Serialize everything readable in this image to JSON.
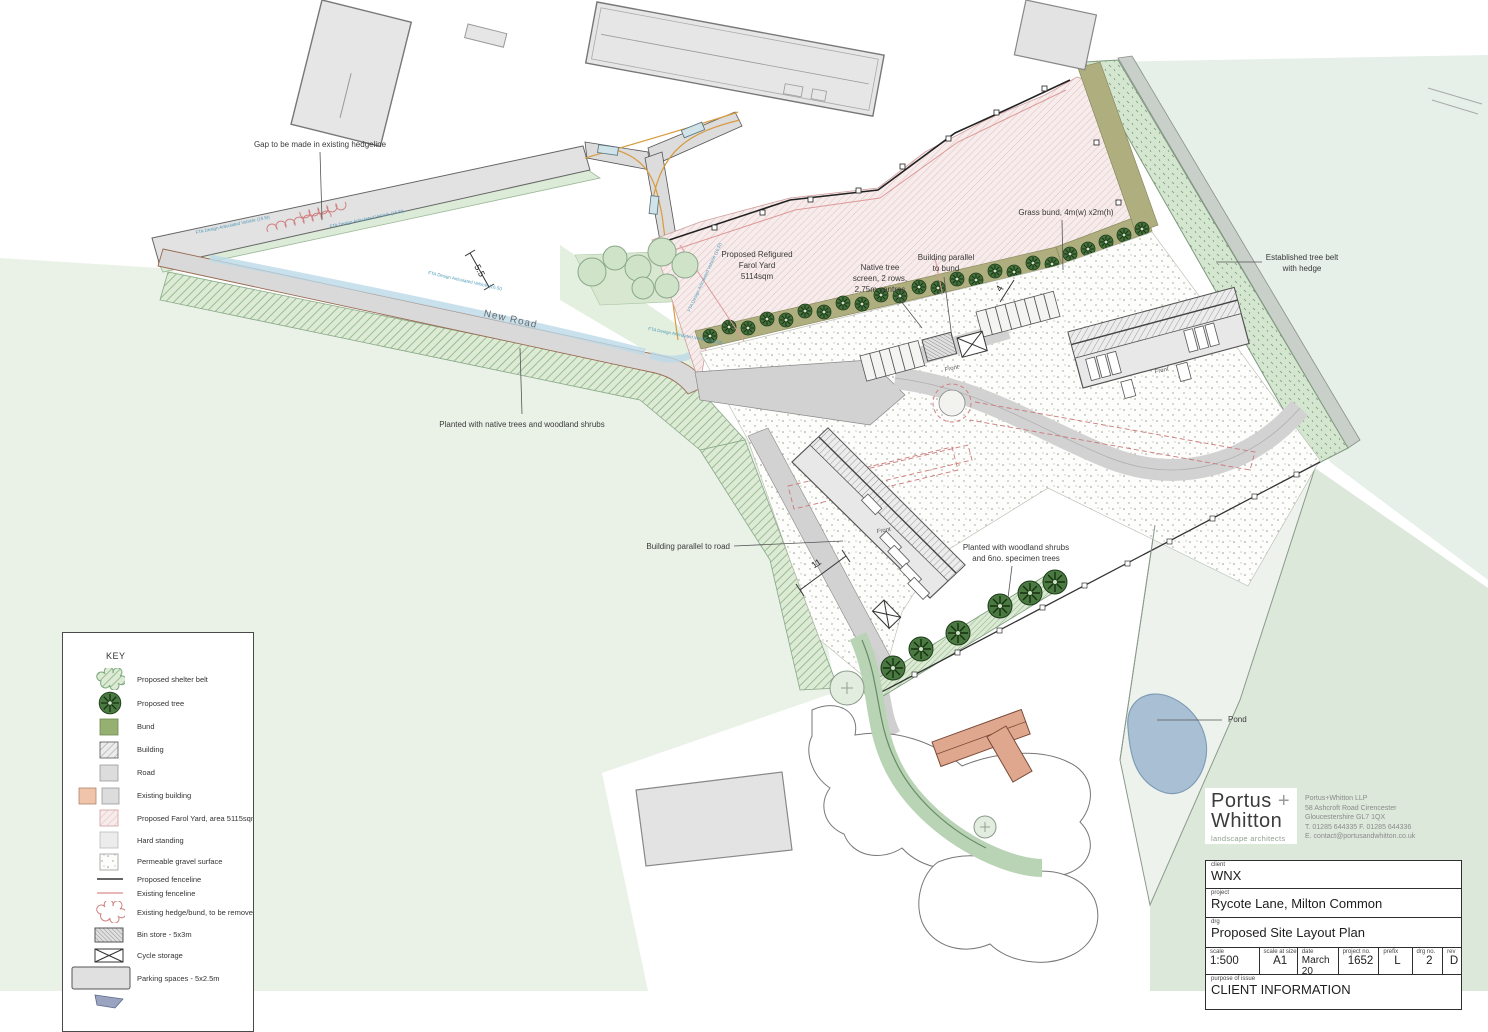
{
  "plan": {
    "road_label": "New Road",
    "front_label": "Front",
    "fta_label": "FTA Design Articulated Vehicle (16.5t)",
    "dim_road_width": "5.5",
    "dim_bund": "4",
    "dim_building": "11"
  },
  "annotations": {
    "gap_hedgeline": "Gap to be made in existing hedgeline",
    "farol_yard": [
      "Proposed Refigured",
      "Farol Yard",
      "5114sqm"
    ],
    "native_screen": [
      "Native tree",
      "screen, 2 rows,",
      "2.75m centres"
    ],
    "building_bund": [
      "Building parallel",
      "to bund"
    ],
    "grass_bund": "Grass bund, 4m(w) x2m(h)",
    "tree_belt": [
      "Established tree belt",
      "with hedge"
    ],
    "planted_native": "Planted with native trees and woodland shrubs",
    "building_road": "Building parallel to road",
    "planted_woodland": [
      "Planted with woodland shrubs",
      "and 6no. specimen trees"
    ],
    "pond": "Pond"
  },
  "key": {
    "title": "KEY",
    "items": [
      {
        "label": "Proposed shelter belt"
      },
      {
        "label": "Proposed tree"
      },
      {
        "label": "Bund"
      },
      {
        "label": "Building"
      },
      {
        "label": "Road"
      },
      {
        "label": "Existing building"
      },
      {
        "label": "Proposed Farol Yard, area 5115sqm"
      },
      {
        "label": "Hard standing"
      },
      {
        "label": "Permeable gravel surface"
      },
      {
        "label": "Proposed fenceline"
      },
      {
        "label": "Existing fenceline"
      },
      {
        "label": "Existing hedge/bund, to be removed"
      },
      {
        "label": "Bin store - 5x3m"
      },
      {
        "label": "Cycle storage"
      },
      {
        "label": "Parking spaces - 5x2.5m"
      }
    ]
  },
  "logo": {
    "name_line1": "Portus",
    "name_plus": "+",
    "name_line2": "Whitton",
    "tagline": "landscape architects",
    "address": [
      "Portus+Whitton LLP",
      "58 Ashcroft Road   Cirencester",
      "Gloucestershire  GL7 1QX",
      "T. 01285 644335    F. 01285 644336",
      "E. contact@portusandwhitton.co.uk"
    ]
  },
  "title_block": {
    "client_label": "client",
    "client": "WNX",
    "project_label": "project",
    "project": "Rycote Lane, Milton Common",
    "drg_label": "drg",
    "drg": "Proposed Site Layout Plan",
    "scale_label": "scale",
    "scale": "1:500",
    "scale_size_label": "scale at size",
    "scale_size": "A1",
    "date_label": "date",
    "date": "March 20",
    "project_no_label": "project no.",
    "project_no": "1652",
    "prefix_label": "prefix",
    "prefix": "L",
    "drg_no_label": "drg no.",
    "drg_no": "2",
    "rev_label": "rev",
    "rev": "D",
    "purpose_label": "purpose of issue",
    "purpose": "CLIENT INFORMATION"
  },
  "colors": {
    "field_green": "#eaf2e8",
    "field_green_dark": "#dce8da",
    "belt_green": "#d8e8d2",
    "bund_olive": "#aeae7f",
    "yard_pink": "#f6eaea",
    "road_grey": "#d9d9d9",
    "pond_blue": "#a9c0d4",
    "tree_green": "#44703c",
    "existing_building_salmon": "#dfa88e",
    "existing_fence_pink": "#dd9a9a",
    "fta_blue": "#4f9ab8"
  }
}
